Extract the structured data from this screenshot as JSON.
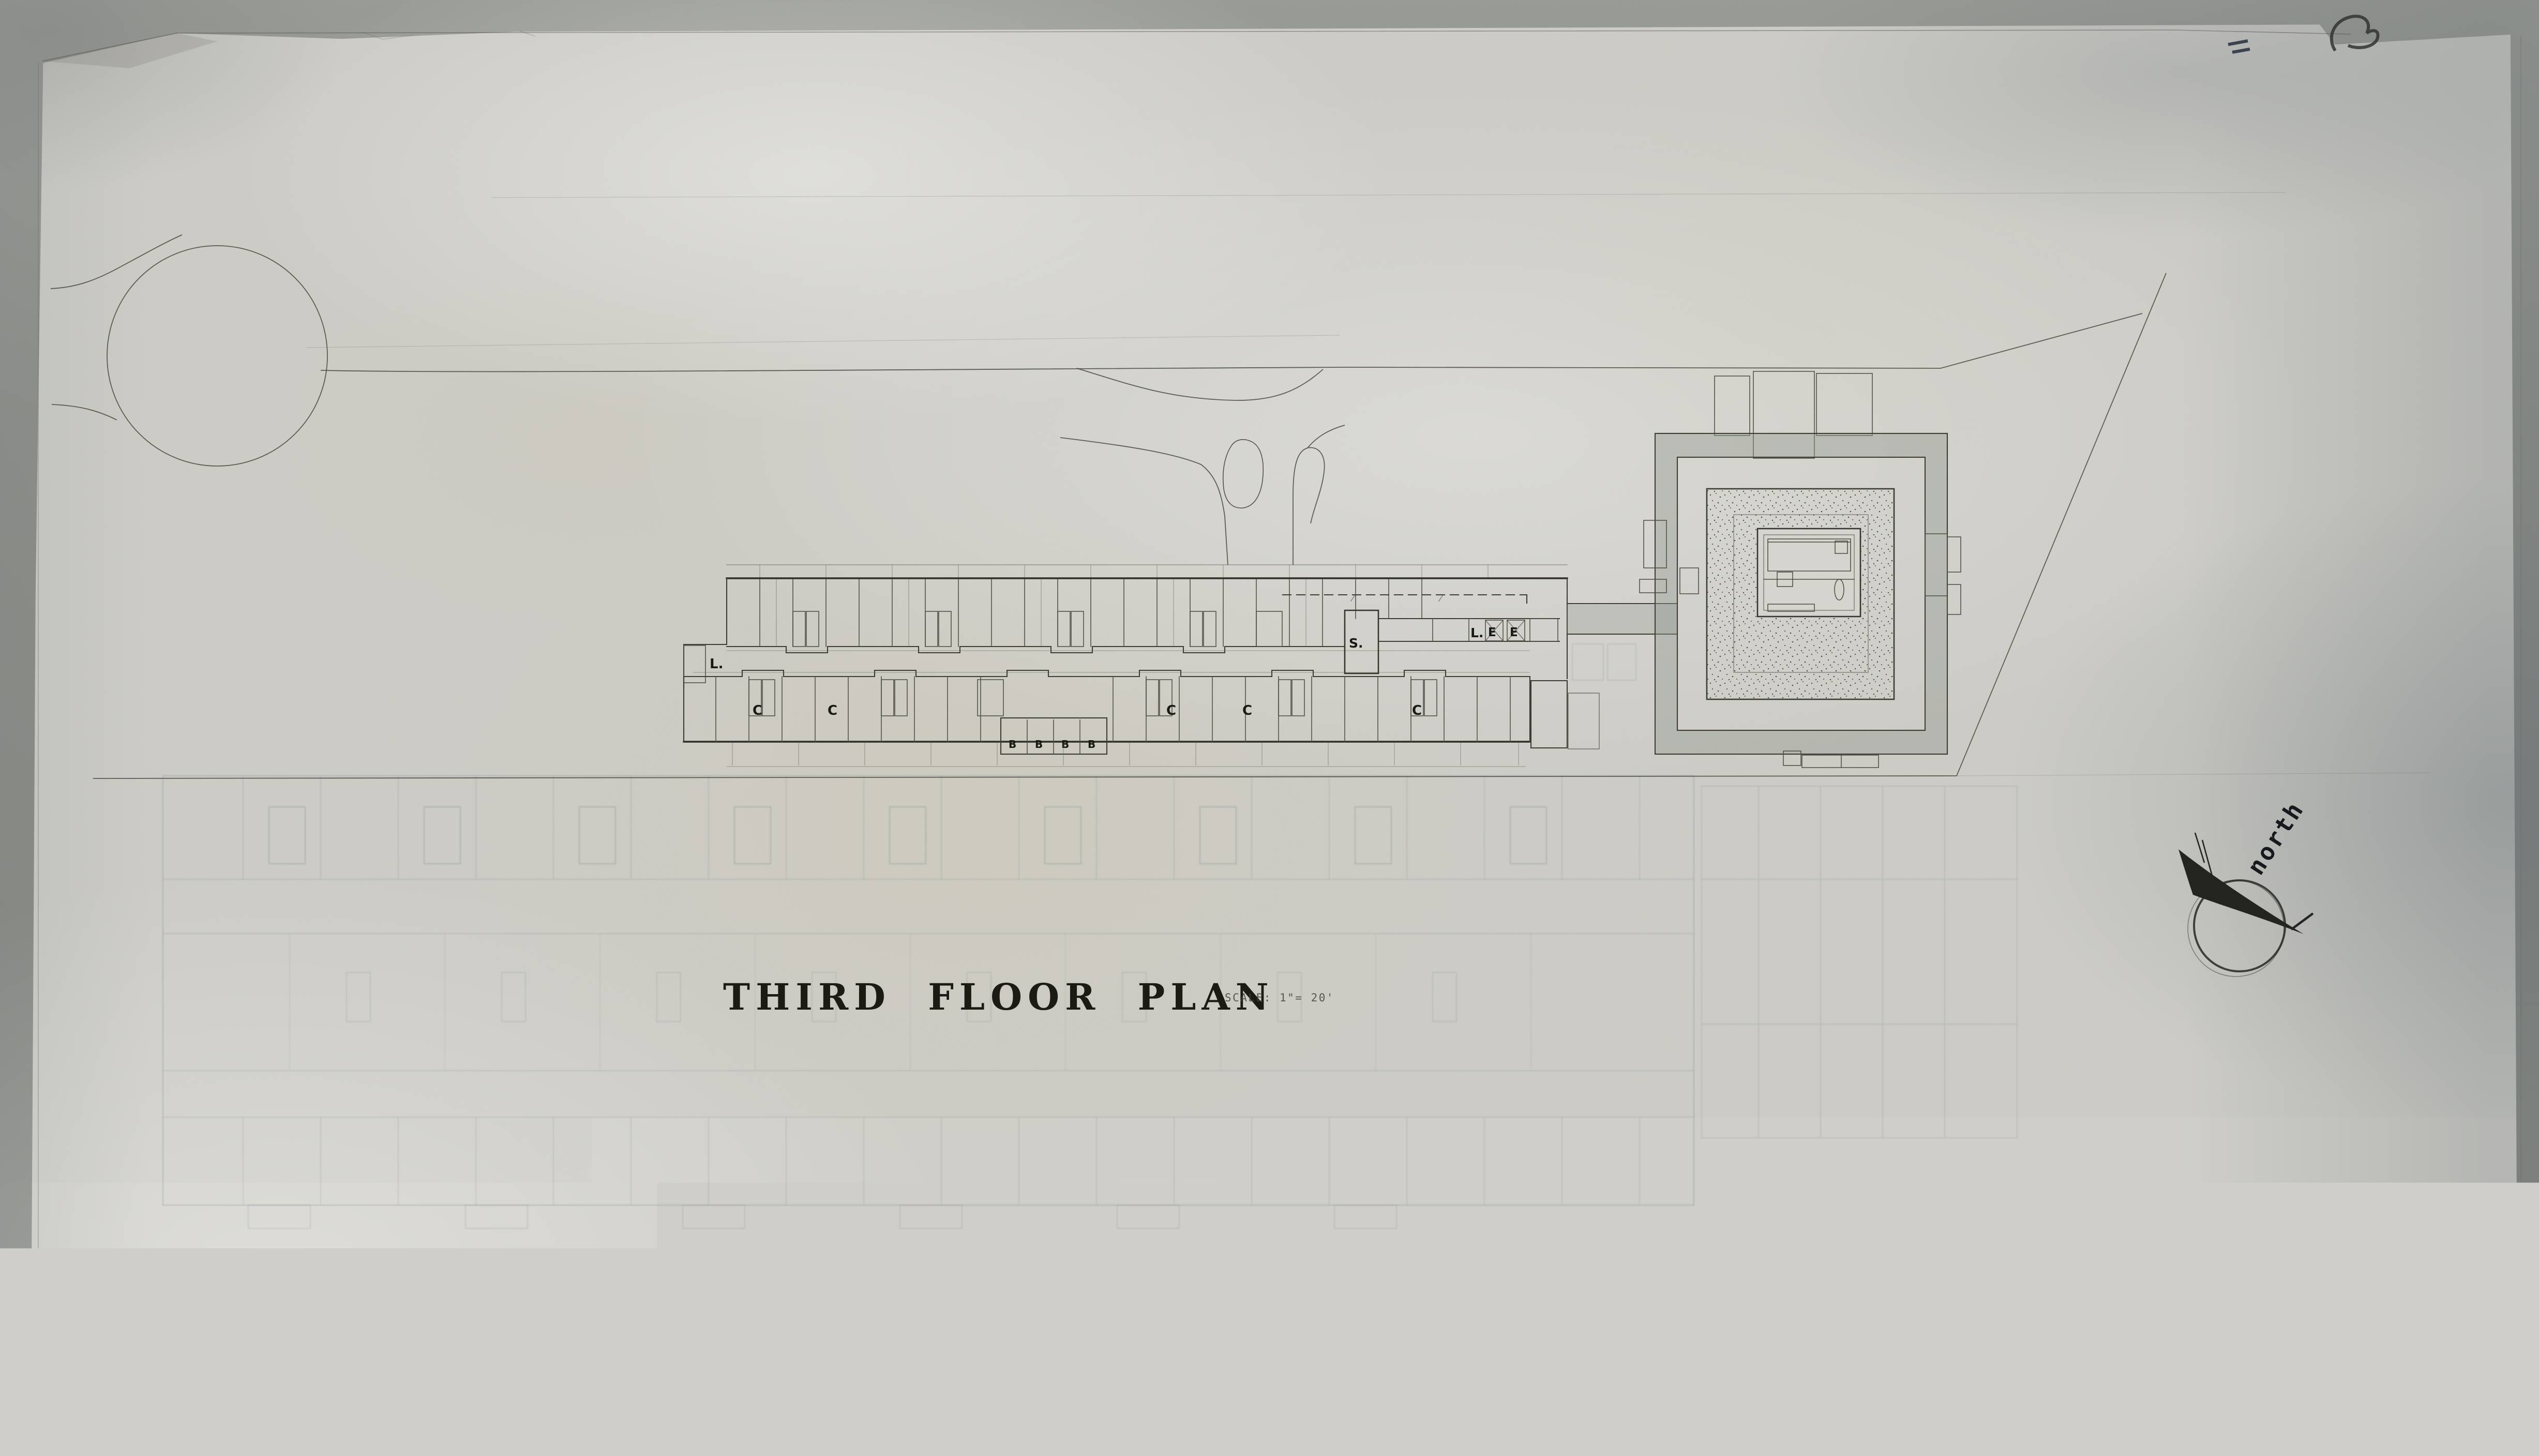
{
  "document": {
    "title": "THIRD FLOOR PLAN",
    "scale_note": "SCALE: 1\"= 20'",
    "ghost_title": "SECOND FLOOR PLAN",
    "compass_label": "north"
  },
  "plan_labels": {
    "stair_west": "L.",
    "stair_core": "S.",
    "lobby": "L.",
    "elevator": "E",
    "unit_c": "C",
    "unit_b": "B"
  },
  "colors": {
    "paper": "#cfcec8",
    "graphite_dark": "#2c2c25",
    "graphite": "#44443b",
    "ink": "#15150f",
    "ghost_blue": "#6e7a84",
    "table": "#8c8e89"
  }
}
